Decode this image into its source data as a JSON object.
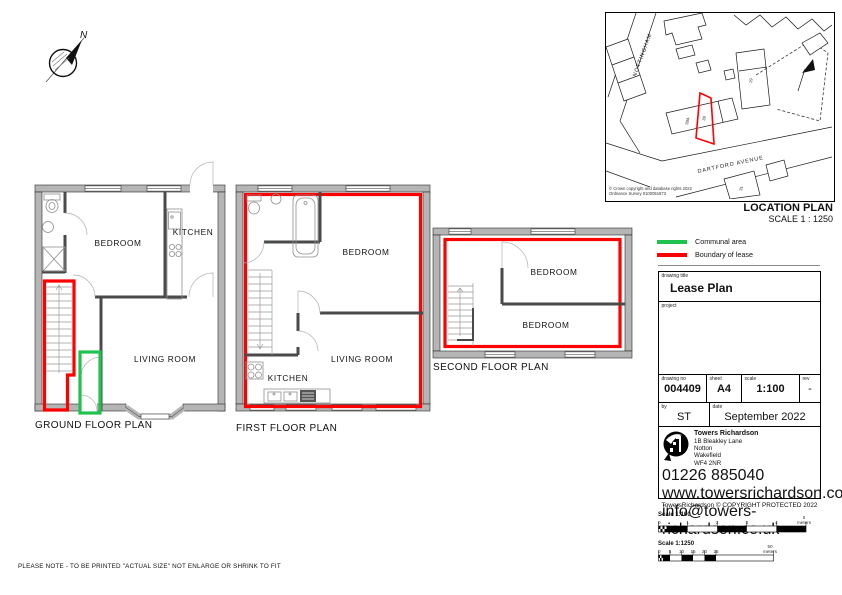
{
  "note": "PLEASE NOTE - TO BE PRINTED \"ACTUAL SIZE\" NOT ENLARGE OR SHRINK TO FIT",
  "compass": {
    "north_label": "N"
  },
  "plans": {
    "ground": {
      "title": "GROUND FLOOR PLAN",
      "bedroom": "BEDROOM",
      "kitchen": "KITCHEN",
      "living_room": "LIVING ROOM"
    },
    "first": {
      "title": "FIRST FLOOR PLAN",
      "bedroom": "BEDROOM",
      "kitchen": "KITCHEN",
      "living_room": "LIVING ROOM"
    },
    "second": {
      "title": "SECOND FLOOR PLAN",
      "bedroom_front": "BEDROOM",
      "bedroom_back": "BEDROOM"
    }
  },
  "location_plan": {
    "title": "LOCATION PLAN",
    "scale_text": "SCALE 1 : 1250",
    "copyright_line1": "© Crown copyright and database rights 2022",
    "copyright_line2": "Ordnance Survey 0100051873",
    "street_1": "NOTTINGHAM",
    "street_2": "DARTFORD AVENUE",
    "plot_39": "39",
    "plot_39a": "39A",
    "plot_29": "29",
    "plot_31": "31"
  },
  "legend": {
    "communal": {
      "label": "Communal area",
      "color": "#1fc24c"
    },
    "boundary": {
      "label": "Boundary of lease",
      "color": "#ff0000"
    }
  },
  "title_block": {
    "drawing_title_label": "drawing title",
    "drawing_title": "Lease Plan",
    "project_label": "project",
    "drawing_no_label": "drawing no",
    "drawing_no": "004409",
    "sheet_label": "sheet",
    "sheet": "A4",
    "scale_label": "scale",
    "scale": "1:100",
    "rev_label": "rev",
    "rev": "-",
    "by_label": "by",
    "by": "ST",
    "date_label": "date",
    "date": "September 2022"
  },
  "company": {
    "name": "Towers Richardson",
    "address_1": "1B Bleakley Lane",
    "address_2": "Notton",
    "address_3": "Wakefield",
    "address_4": "WF4 2NR",
    "phone": "01226 885040",
    "website": "www.towersrichardson.com",
    "email": "info@towers-richardson.co.uk",
    "services": [
      "Land Registry Plans",
      "Title Plans",
      "Lease Plans",
      "Measured Surveys",
      "Floor Plans",
      "CAD Drafting"
    ],
    "copyright": "TowersRichardson © COPYRIGHT PROTECTED 2022"
  },
  "scale_bars": {
    "bar_100": {
      "label": "Scale 1:100",
      "ticks": [
        "0",
        "1",
        "2",
        "3",
        "4"
      ],
      "end_value": "5",
      "unit": "meters"
    },
    "bar_1250": {
      "label": "Scale 1:1250",
      "ticks": [
        "0",
        "5",
        "10",
        "15",
        "20",
        "25"
      ],
      "end_value": "50",
      "unit": "meters"
    }
  }
}
